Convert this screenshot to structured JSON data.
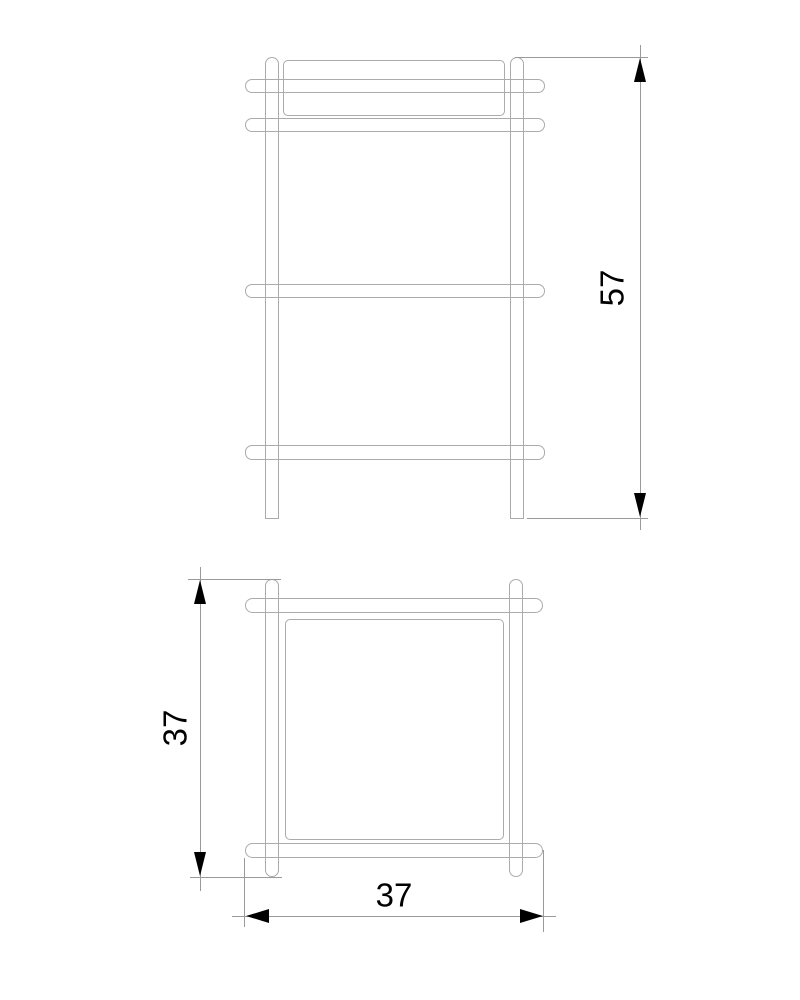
{
  "drawing": {
    "type": "technical-drawing",
    "description": "Two-view orthographic drawing of a shelf side table: front elevation with four protruding rails and two legs, plan view with overlapping frame rails and tabletop",
    "views": {
      "front": {
        "name": "front-elevation",
        "height_dimension": {
          "value": "57",
          "orientation": "vertical"
        }
      },
      "plan": {
        "name": "plan-view",
        "depth_dimension": {
          "value": "37",
          "orientation": "vertical"
        },
        "width_dimension": {
          "value": "37",
          "orientation": "horizontal"
        }
      }
    },
    "colors": {
      "background": "#ffffff",
      "geometry_line": "#ababab",
      "dimension_line": "#9a9a9a",
      "arrow_and_text": "#000000"
    }
  }
}
